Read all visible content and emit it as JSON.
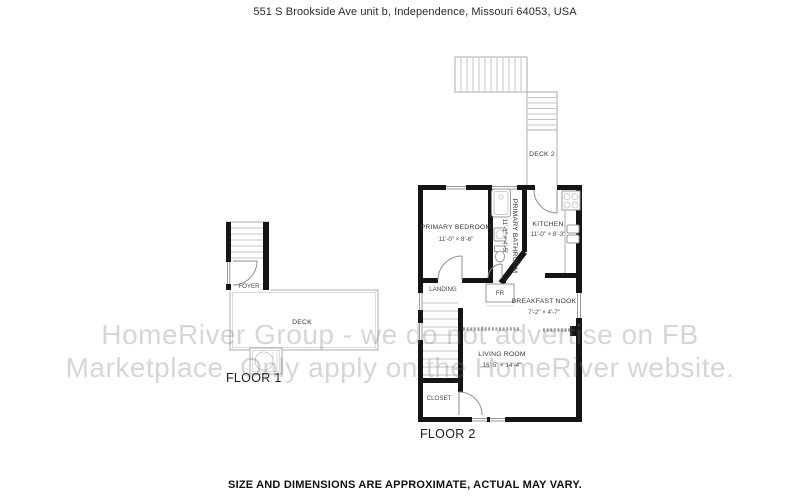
{
  "header": {
    "address": "551 S Brookside Ave unit b, Independence, Missouri 64053, USA"
  },
  "watermark": {
    "line1": "HomeRiver Group - we do not advertise on FB",
    "line2": "Marketplace. Only apply on the HomeRiver website."
  },
  "floor1": {
    "label": "FLOOR 1",
    "rooms": {
      "foyer": {
        "name": "FOYER"
      },
      "deck": {
        "name": "DECK"
      }
    }
  },
  "floor2": {
    "label": "FLOOR 2",
    "deck2": {
      "name": "DECK 2"
    },
    "rooms": {
      "primary_bedroom": {
        "name": "PRIMARY BEDROOM",
        "dims": "11'-0\" × 8'-6\""
      },
      "primary_bathroom": {
        "name": "PRIMARY BATHROOM",
        "dims": "11'-1\" × 4'-5\""
      },
      "kitchen": {
        "name": "KITCHEN",
        "dims": "11'-0\" × 8'-3\""
      },
      "landing": {
        "name": "LANDING"
      },
      "fridge": {
        "name": "FR"
      },
      "breakfast_nook": {
        "name": "BREAKFAST NOOK",
        "dims": "7'-2\" × 4'-7\""
      },
      "living_room": {
        "name": "LIVING ROOM",
        "dims": "16'-5\" × 14'-4\""
      },
      "closet": {
        "name": "CLOSET"
      }
    }
  },
  "footer": {
    "disclaimer": "SIZE AND DIMENSIONS ARE APPROXIMATE, ACTUAL MAY VARY."
  },
  "colors": {
    "wall": "#151515",
    "fixture_line": "#9a9a9a",
    "deck_line": "#ababab",
    "stair_tread": "#c6c6c6",
    "label_text": "#383838",
    "watermark_text": "#dedede"
  }
}
